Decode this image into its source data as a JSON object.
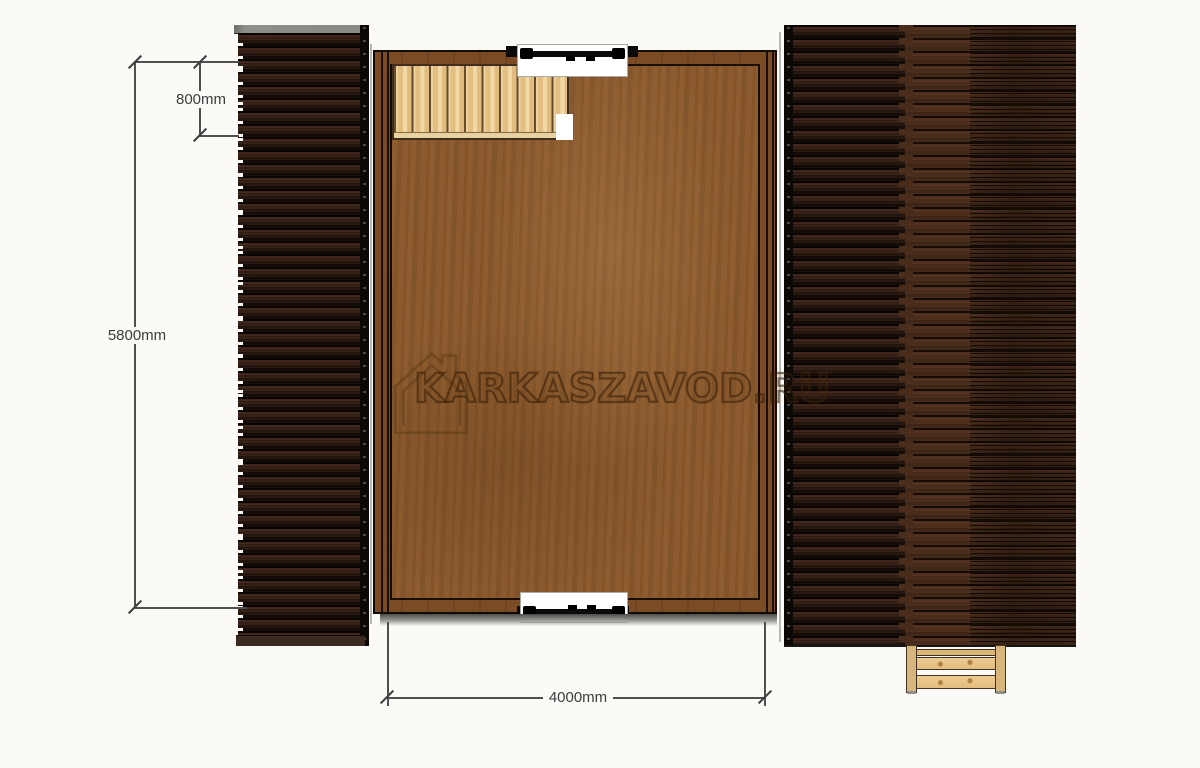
{
  "watermark": {
    "text": "KARKASZAVOD.RU",
    "icon": "house-logo-icon",
    "outline_color": "#3a2206"
  },
  "dimensions": {
    "stair_depth": {
      "label": "800mm",
      "value_mm": 800,
      "orientation": "vertical"
    },
    "building_length": {
      "label": "5800mm",
      "value_mm": 5800,
      "orientation": "vertical"
    },
    "floor_width": {
      "label": "4000mm",
      "value_mm": 4000,
      "orientation": "horizontal"
    }
  },
  "plan": {
    "view": "top-down floor plan of a wooden frame house",
    "elements": [
      {
        "name": "left-roof-slope",
        "finish": "dark brown horizontal planks"
      },
      {
        "name": "right-roof-slope",
        "finish": "dark brown horizontal planks, two bands"
      },
      {
        "name": "main-floor",
        "finish": "brown plywood"
      },
      {
        "name": "staircase",
        "location": "top-left corner",
        "treads": 10
      },
      {
        "name": "door-top",
        "location": "top wall center"
      },
      {
        "name": "door-bottom",
        "location": "bottom wall center"
      },
      {
        "name": "entry-steps",
        "location": "bottom-right under roof"
      }
    ]
  },
  "colors": {
    "background": "#fbfaf6",
    "floor_wood": "#8a5a2e",
    "wall_wood": "#7b4b26",
    "roof_dark": "#2e1c13",
    "roof_brown": "#4d2e1c",
    "stair_wood": "#e8c88d",
    "dimension_line": "#4f4f4f"
  }
}
